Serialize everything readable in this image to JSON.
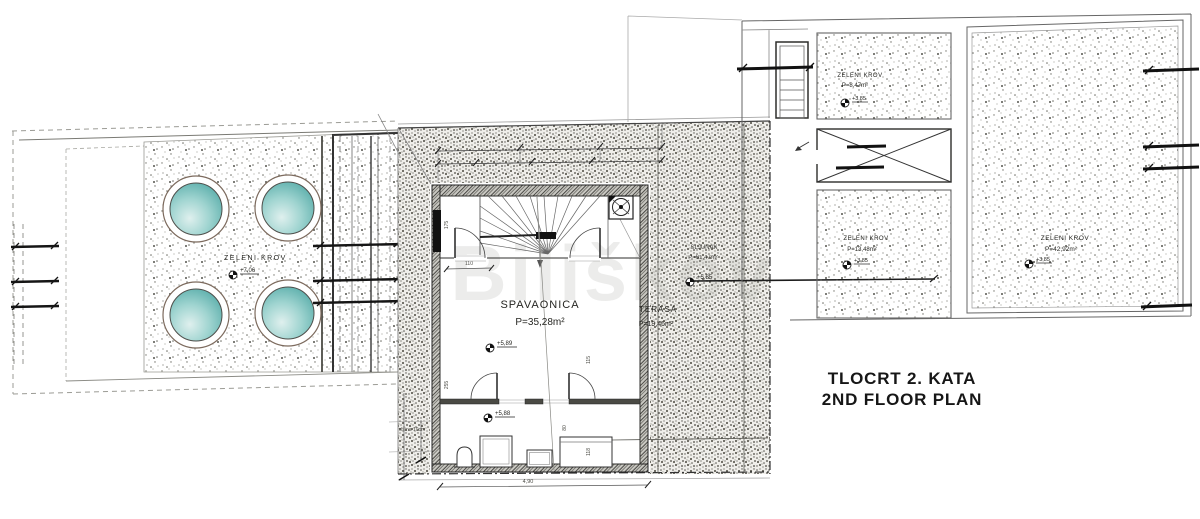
{
  "title": {
    "line1": "TLOCRT 2. KATA",
    "line2": "2ND FLOOR PLAN"
  },
  "watermark": "Biliškov",
  "left_roof": {
    "name": "ZELENI KROV",
    "elevation": "+7,06"
  },
  "bedroom": {
    "name": "SPAVAONICA",
    "area": "P=35,28m²",
    "elevation_upper": "+5,89",
    "elevation_lower": "+5,88"
  },
  "terrace": {
    "name": "TERASA",
    "area": "P=19,46m²",
    "elevation": "+5,85"
  },
  "gravel": {
    "name": "ŠLJUNAK",
    "area": "P=61,47m²"
  },
  "roof_small": {
    "name": "ZELENI KROV",
    "area": "P=8,47m²",
    "elevation": "+3,85"
  },
  "roof_mid": {
    "name": "ZELENI KROV",
    "area": "P=13,48m²",
    "elevation": "+3,85"
  },
  "roof_large": {
    "name": "ZELENI KROV",
    "area": "P=42,92m²",
    "elevation": "+3,85"
  },
  "dims": {
    "width_bottom": "4,90",
    "d110": "110",
    "d175": "175",
    "d255": "255",
    "d115": "115",
    "d80": "80",
    "d118": "118",
    "visina": "visina 10cm"
  },
  "colors": {
    "dome_teal": "#5fb5b2",
    "ink": "#2e2e2b",
    "paper": "#ffffff"
  }
}
